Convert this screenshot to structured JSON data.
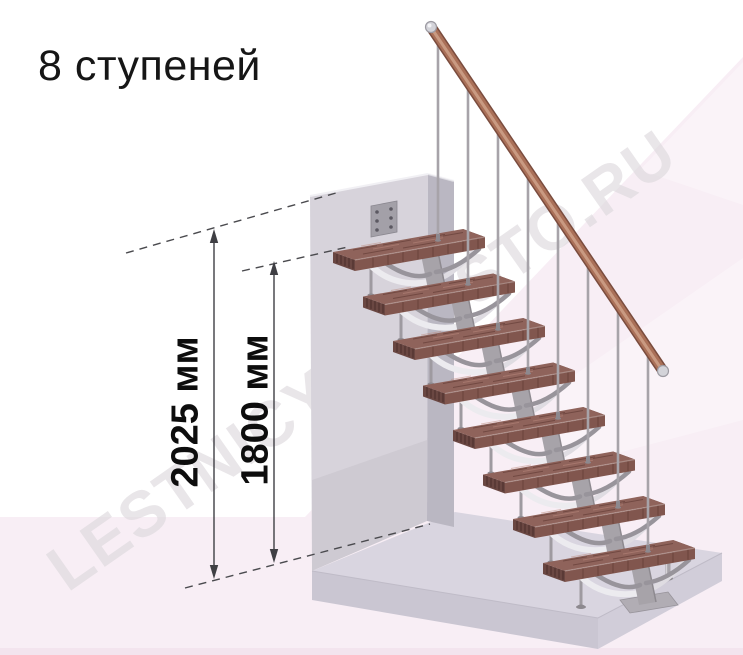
{
  "page": {
    "title": "8 ступеней"
  },
  "watermark": {
    "text": "LESTNICY-PROSTO.RU"
  },
  "diagram": {
    "subject": "modular staircase side view",
    "steps_count": 8,
    "dimensions": [
      {
        "id": "overall-height",
        "label": "2025 мм",
        "value": 2025,
        "unit": "мм"
      },
      {
        "id": "top-tread-height",
        "label": "1800 мм",
        "value": 1800,
        "unit": "мм"
      }
    ]
  },
  "colors": {
    "background": "#ffffff",
    "floor-pink": "#f8eef5",
    "floor-strip": "#f3e4ee",
    "slab-top": "#d9d5e0",
    "slab-front": "#cac6d2",
    "slab-side": "#d1cdd9",
    "wall-front": "#d7d3db",
    "wall-side": "#bab7c2",
    "tread-top": "#8f635b",
    "tread-front": "#81564e",
    "tread-end": "#6a4742",
    "metal": "#a7a3a9",
    "metal-dark": "#8d898f",
    "metal-mid": "#98949b",
    "metal-light": "#ecebef",
    "rail-dark": "#7a4c3e",
    "rail-mid": "#aa7058",
    "rail-light": "#cfa189",
    "cap-silver": "#d3d3d9",
    "dim": "#3f3f44",
    "text": "#161616",
    "watermark": "#dcd8dc"
  }
}
